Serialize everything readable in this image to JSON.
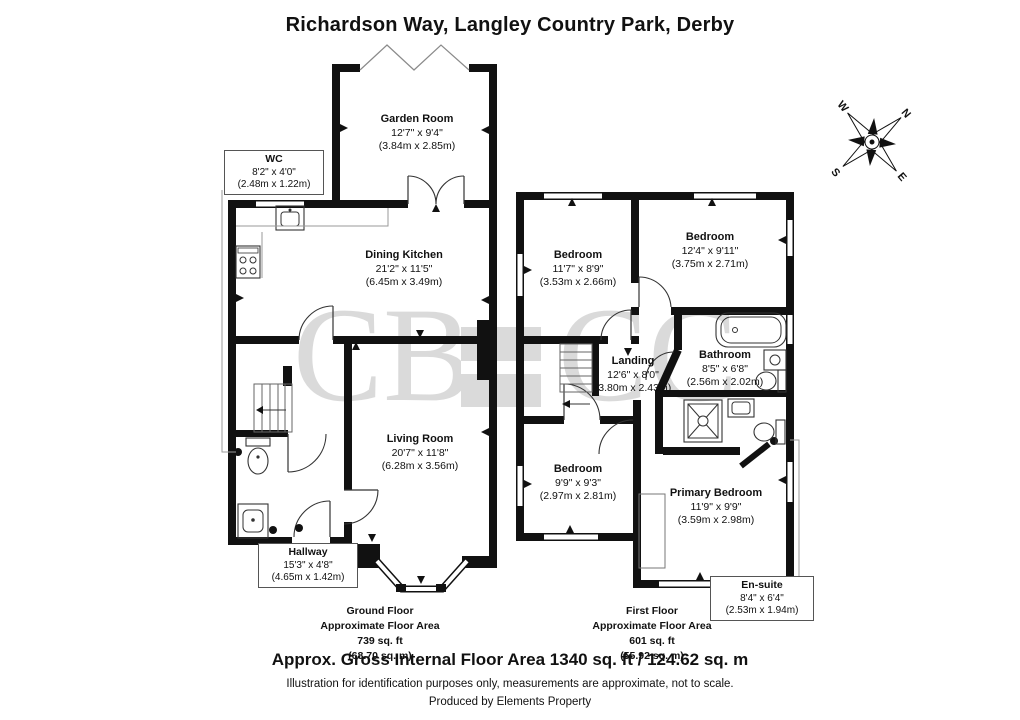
{
  "title": "Richardson Way, Langley Country Park, Derby",
  "watermark": {
    "left": "CB",
    "right": "CC"
  },
  "compass": {
    "n": "N",
    "e": "E",
    "s": "S",
    "w": "W"
  },
  "ground_floor": {
    "rooms": [
      {
        "name": "Garden Room",
        "imperial": "12'7\" x 9'4\"",
        "metric": "(3.84m x 2.85m)"
      },
      {
        "name": "WC",
        "imperial": "8'2\" x 4'0\"",
        "metric": "(2.48m x 1.22m)"
      },
      {
        "name": "Dining Kitchen",
        "imperial": "21'2\" x 11'5\"",
        "metric": "(6.45m x 3.49m)"
      },
      {
        "name": "Living Room",
        "imperial": "20'7\" x 11'8\"",
        "metric": "(6.28m x 3.56m)"
      },
      {
        "name": "Hallway",
        "imperial": "15'3\" x 4'8\"",
        "metric": "(4.65m x 1.42m)"
      }
    ],
    "summary": {
      "floor": "Ground Floor",
      "area_label": "Approximate Floor Area",
      "area_ft": "739 sq. ft",
      "area_m": "(68.70 sq. m)"
    }
  },
  "first_floor": {
    "rooms": [
      {
        "name": "Bedroom",
        "imperial": "11'7\" x 8'9\"",
        "metric": "(3.53m x 2.66m)"
      },
      {
        "name": "Bedroom",
        "imperial": "12'4\" x 9'11\"",
        "metric": "(3.75m x 2.71m)"
      },
      {
        "name": "Landing",
        "imperial": "12'6\" x 8'0\"",
        "metric": "(3.80m x 2.43m)"
      },
      {
        "name": "Bathroom",
        "imperial": "8'5\" x 6'8\"",
        "metric": "(2.56m x 2.02m)"
      },
      {
        "name": "Bedroom",
        "imperial": "9'9\" x 9'3\"",
        "metric": "(2.97m x 2.81m)"
      },
      {
        "name": "Primary Bedroom",
        "imperial": "11'9\" x 9'9\"",
        "metric": "(3.59m x 2.98m)"
      },
      {
        "name": "En-suite",
        "imperial": "8'4\" x 6'4\"",
        "metric": "(2.53m x 1.94m)"
      }
    ],
    "summary": {
      "floor": "First Floor",
      "area_label": "Approximate Floor Area",
      "area_ft": "601 sq. ft",
      "area_m": "(55.92 sq. m)"
    }
  },
  "footer": {
    "total": "Approx. Gross Internal Floor Area 1340 sq. ft / 124.62 sq. m",
    "disclaimer": "Illustration for identification purposes only, measurements are approximate, not to scale.",
    "producer": "Produced by Elements Property"
  }
}
